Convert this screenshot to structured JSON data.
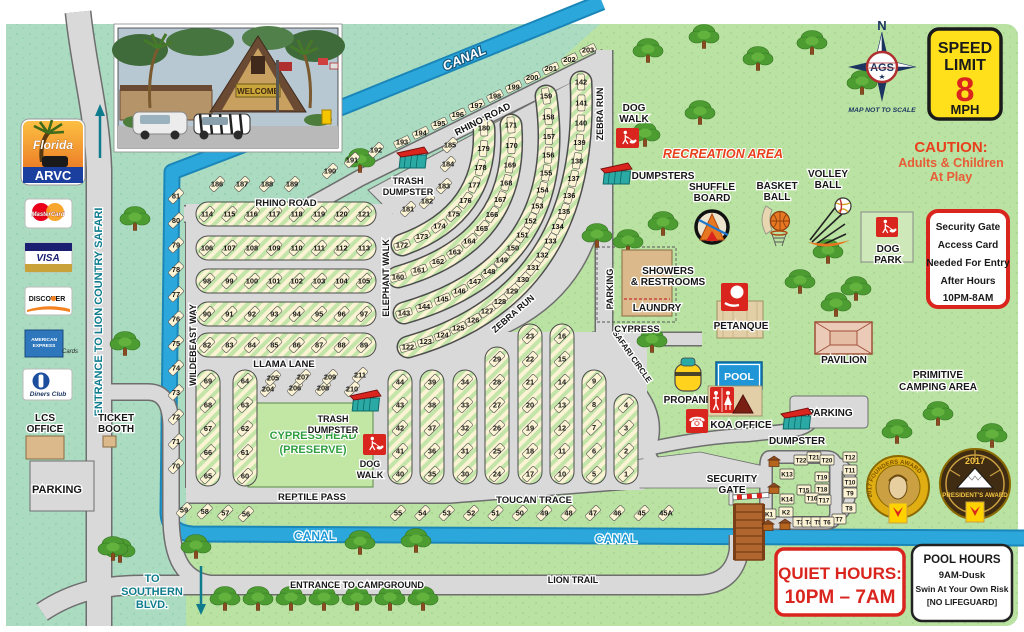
{
  "photo": {
    "welcome": "WELCOME"
  },
  "logo": {
    "florida": "Florida",
    "arvc": "ARVC"
  },
  "cards": {
    "mastercard": "MasterCard",
    "visa": "VISA",
    "discover": "DISCOVER",
    "amex1": "AMERICAN",
    "amex2": "EXPRESS",
    "amex_cards": "Cards",
    "diners": "Diners Club"
  },
  "left": {
    "entrance_lcs": "ENTRANCE TO LION COUNTRY SAFARI",
    "lcs1": "LCS",
    "lcs2": "OFFICE",
    "ticket1": "TICKET",
    "ticket2": "BOOTH",
    "parking": "PARKING",
    "south1": "TO",
    "south2": "SOUTHERN",
    "south3": "BLVD."
  },
  "compass": {
    "n": "N",
    "ags": "AGS",
    "note": "MAP NOT TO SCALE"
  },
  "speed": {
    "l1": "SPEED",
    "l2": "LIMIT",
    "num": "8",
    "mph": "MPH"
  },
  "caution": {
    "l1": "CAUTION:",
    "l2": "Adults & Children",
    "l3": "At Play"
  },
  "security_box": {
    "l1": "Security Gate",
    "l2": "Access Card",
    "l3": "Needed For Entry",
    "l4": "After Hours",
    "l5": "10PM-8AM"
  },
  "quiet": {
    "l1": "QUIET HOURS:",
    "l2": "10PM – 7AM"
  },
  "pool_hours": {
    "l1": "POOL HOURS",
    "l2": "9AM-Dusk",
    "l3": "Swin At Your Own Risk",
    "l4": "[NO LIFEGUARD]"
  },
  "awards": {
    "founders": "2017 FOUNDERS AWARD",
    "presidents_year": "2017",
    "presidents": "PRESIDENT'S AWARD"
  },
  "roads": {
    "rhino": "RHINO ROAD",
    "llama": "LLAMA LANE",
    "reptile": "REPTILE PASS",
    "toucan": "TOUCAN TRACE",
    "wildebeast": "WILDEBEAST WAY",
    "elephant": "ELEPHANT WALK",
    "zebra": "ZEBRA RUN",
    "safari": "SAFARI CIRCLE",
    "cypress": "CYPRESS",
    "lion": "LION TRAIL",
    "entrance_cg": "ENTRANCE TO CAMPGROUND",
    "canal": "CANAL"
  },
  "labels": {
    "recreation": "RECREATION AREA",
    "dog_walk1": "DOG",
    "dog_walk2": "WALK",
    "dog_park1": "DOG",
    "dog_park2": "PARK",
    "dumpsters": "DUMPSTERS",
    "dumpster": "DUMPSTER",
    "trash1": "TRASH",
    "trash2": "DUMPSTER",
    "shuffle1": "SHUFFLE",
    "shuffle2": "BOARD",
    "basket1": "BASKET",
    "basket2": "BALL",
    "volley1": "VOLLEY",
    "volley2": "BALL",
    "showers1": "SHOWERS",
    "showers2": "& RESTROOMS",
    "laundry": "LAUNDRY",
    "petanque": "PETANQUE",
    "pool": "POOL",
    "propane": "PROPANE",
    "koa": "KOA OFFICE",
    "pavilion": "PAVILION",
    "parking": "PARKING",
    "primitive1": "PRIMITIVE",
    "primitive2": "CAMPING AREA",
    "security1": "SECURITY",
    "security2": "GATE",
    "cypress_head1": "CYPRESS HEAD",
    "cypress_head2": "(PRESERVE)"
  },
  "colors": {
    "canal": "#2ba7dc",
    "teal_bg": "#abdcc2",
    "green_bg": "#bae2a3",
    "road": "#d9d9d9",
    "site_cream": "#fbf3d3",
    "accent_red": "#d9251d",
    "koa_yellow": "#ffd200"
  },
  "site_groups": [
    {
      "id": "row-114",
      "kind": "line",
      "from": [
        207,
        214
      ],
      "to": [
        364,
        214
      ],
      "nums": [
        "114",
        "115",
        "116",
        "117",
        "118",
        "119",
        "120",
        "121"
      ]
    },
    {
      "id": "row-106",
      "kind": "line",
      "from": [
        207,
        248
      ],
      "to": [
        364,
        248
      ],
      "nums": [
        "106",
        "107",
        "108",
        "109",
        "110",
        "111",
        "112",
        "113"
      ]
    },
    {
      "id": "row-98",
      "kind": "line",
      "from": [
        207,
        281
      ],
      "to": [
        364,
        281
      ],
      "nums": [
        "98",
        "99",
        "100",
        "101",
        "102",
        "103",
        "104",
        "105"
      ]
    },
    {
      "id": "row-90",
      "kind": "line",
      "from": [
        207,
        314
      ],
      "to": [
        364,
        314
      ],
      "nums": [
        "90",
        "91",
        "92",
        "93",
        "94",
        "95",
        "96",
        "97"
      ]
    },
    {
      "id": "row-82",
      "kind": "line",
      "from": [
        207,
        345
      ],
      "to": [
        364,
        345
      ],
      "nums": [
        "82",
        "83",
        "84",
        "85",
        "86",
        "87",
        "88",
        "89"
      ]
    },
    {
      "id": "col-w",
      "kind": "line",
      "from": [
        176,
        196
      ],
      "to": [
        176,
        466
      ],
      "nums": [
        "81",
        "80",
        "79",
        "78",
        "77",
        "76",
        "75",
        "74",
        "73",
        "72",
        "71",
        "70"
      ]
    },
    {
      "id": "col-69",
      "kind": "line",
      "from": [
        208,
        381
      ],
      "to": [
        208,
        476
      ],
      "nums": [
        "69",
        "68",
        "67",
        "66",
        "65"
      ]
    },
    {
      "id": "col-64",
      "kind": "line",
      "from": [
        245,
        381
      ],
      "to": [
        245,
        476
      ],
      "nums": [
        "64",
        "63",
        "62",
        "61",
        "60"
      ]
    },
    {
      "id": "col-44",
      "kind": "line",
      "from": [
        400,
        382
      ],
      "to": [
        400,
        474
      ],
      "nums": [
        "44",
        "43",
        "42",
        "41",
        "40"
      ]
    },
    {
      "id": "col-39",
      "kind": "line",
      "from": [
        432,
        382
      ],
      "to": [
        432,
        474
      ],
      "nums": [
        "39",
        "38",
        "37",
        "36",
        "35"
      ]
    },
    {
      "id": "col-34",
      "kind": "line",
      "from": [
        465,
        382
      ],
      "to": [
        465,
        474
      ],
      "nums": [
        "34",
        "33",
        "32",
        "31",
        "30"
      ]
    },
    {
      "id": "col-29",
      "kind": "line",
      "from": [
        497,
        359
      ],
      "to": [
        497,
        474
      ],
      "nums": [
        "29",
        "28",
        "27",
        "26",
        "25",
        "24"
      ]
    },
    {
      "id": "col-23",
      "kind": "line",
      "from": [
        530,
        336
      ],
      "to": [
        530,
        474
      ],
      "nums": [
        "23",
        "22",
        "21",
        "20",
        "19",
        "18",
        "17"
      ]
    },
    {
      "id": "col-16",
      "kind": "line",
      "from": [
        562,
        336
      ],
      "to": [
        562,
        474
      ],
      "nums": [
        "16",
        "15",
        "14",
        "13",
        "12",
        "11",
        "10"
      ]
    },
    {
      "id": "col-9",
      "kind": "line",
      "from": [
        594,
        381
      ],
      "to": [
        594,
        474
      ],
      "nums": [
        "9",
        "8",
        "7",
        "6",
        "5"
      ]
    },
    {
      "id": "col-4",
      "kind": "line",
      "from": [
        626,
        405
      ],
      "to": [
        626,
        474
      ],
      "nums": [
        "4",
        "3",
        "2",
        "1"
      ]
    },
    {
      "id": "row-59",
      "kind": "line",
      "from": [
        184,
        510
      ],
      "to": [
        246,
        514
      ],
      "nums": [
        "59",
        "58",
        "57",
        "56"
      ]
    },
    {
      "id": "row-55",
      "kind": "line",
      "from": [
        398,
        513
      ],
      "to": [
        666,
        513
      ],
      "nums": [
        "55",
        "54",
        "53",
        "52",
        "51",
        "50",
        "49",
        "48",
        "47",
        "46",
        "45",
        "45A"
      ]
    },
    {
      "id": "arc-122",
      "kind": "bezier",
      "p0": [
        408,
        347
      ],
      "c": [
        590,
        295
      ],
      "p2": [
        581,
        82
      ],
      "nums": [
        "122",
        "123",
        "124",
        "125",
        "126",
        "127",
        "128",
        "129",
        "130",
        "131",
        "132",
        "133",
        "134",
        "135",
        "136",
        "137",
        "138",
        "139",
        "140",
        "141",
        "142"
      ]
    },
    {
      "id": "arc-143",
      "kind": "bezier",
      "p0": [
        404,
        313
      ],
      "c": [
        570,
        265
      ],
      "p2": [
        546,
        96
      ],
      "nums": [
        "143",
        "144",
        "145",
        "146",
        "147",
        "148",
        "149",
        "150",
        "151",
        "152",
        "153",
        "154",
        "155",
        "156",
        "157",
        "158",
        "159"
      ]
    },
    {
      "id": "arc-160",
      "kind": "bezier",
      "p0": [
        398,
        277
      ],
      "c": [
        520,
        242
      ],
      "p2": [
        511,
        125
      ],
      "nums": [
        "160",
        "161",
        "162",
        "163",
        "164",
        "165",
        "166",
        "167",
        "168",
        "169",
        "170",
        "171"
      ]
    },
    {
      "id": "arc-172",
      "kind": "bezier",
      "p0": [
        402,
        245
      ],
      "c": [
        488,
        214
      ],
      "p2": [
        484,
        128
      ],
      "nums": [
        "172",
        "173",
        "174",
        "175",
        "176",
        "177",
        "178",
        "179",
        "180"
      ]
    },
    {
      "id": "pts-181",
      "kind": "points",
      "pts": [
        [
          408,
          209
        ],
        [
          427,
          201
        ],
        [
          444,
          186
        ],
        [
          448,
          164
        ],
        [
          450,
          145
        ]
      ],
      "nums": [
        "181",
        "182",
        "183",
        "184",
        "185"
      ]
    },
    {
      "id": "row-186",
      "kind": "line",
      "from": [
        217,
        184
      ],
      "to": [
        292,
        184
      ],
      "nums": [
        "186",
        "187",
        "188",
        "189"
      ]
    },
    {
      "id": "pts-190",
      "kind": "points",
      "pts": [
        [
          330,
          171
        ],
        [
          352,
          160
        ]
      ],
      "nums": [
        "190",
        "191"
      ]
    },
    {
      "id": "pts-192",
      "kind": "points",
      "pts": [
        [
          376,
          150
        ]
      ],
      "nums": [
        "192"
      ]
    },
    {
      "id": "row-193",
      "kind": "line",
      "from": [
        402,
        142
      ],
      "to": [
        588,
        50
      ],
      "mangle": 64,
      "nums": [
        "193",
        "194",
        "195",
        "196",
        "197",
        "198",
        "199",
        "200",
        "201",
        "202",
        "203"
      ]
    },
    {
      "id": "pts-204",
      "kind": "points",
      "pts": [
        [
          268,
          389
        ],
        [
          273,
          378
        ],
        [
          295,
          388
        ],
        [
          303,
          377
        ],
        [
          323,
          388
        ],
        [
          330,
          377
        ],
        [
          352,
          389
        ],
        [
          360,
          375
        ]
      ],
      "nums": [
        "204",
        "205",
        "206",
        "207",
        "208",
        "209",
        "210",
        "211"
      ]
    },
    {
      "id": "tk-block",
      "kind": "points",
      "marker": "cell",
      "pts": [
        [
          801,
          460
        ],
        [
          814,
          457
        ],
        [
          827,
          460
        ],
        [
          850,
          457
        ],
        [
          787,
          474
        ],
        [
          822,
          477
        ],
        [
          850,
          470
        ],
        [
          850,
          482
        ],
        [
          804,
          490
        ],
        [
          822,
          489
        ],
        [
          850,
          493
        ],
        [
          787,
          499
        ],
        [
          812,
          498
        ],
        [
          824,
          500
        ],
        [
          849,
          508
        ],
        [
          839,
          519
        ],
        [
          769,
          514
        ],
        [
          786,
          512
        ],
        [
          800,
          522
        ],
        [
          809,
          522
        ],
        [
          818,
          522
        ],
        [
          827,
          522
        ]
      ],
      "nums": [
        "T22",
        "T21",
        "T20",
        "T12",
        "K13",
        "T19",
        "T11",
        "T10",
        "T15",
        "T18",
        "T9",
        "K14",
        "T16",
        "T17",
        "T8",
        "T7",
        "K1",
        "K2",
        "T3",
        "T4",
        "T5",
        "T6"
      ]
    }
  ],
  "trees": [
    [
      135,
      230
    ],
    [
      125,
      355
    ],
    [
      120,
      562
    ],
    [
      360,
      172
    ],
    [
      652,
      352
    ],
    [
      800,
      293
    ],
    [
      856,
      300
    ],
    [
      648,
      62
    ],
    [
      704,
      48
    ],
    [
      758,
      70
    ],
    [
      812,
      54
    ],
    [
      862,
      94
    ],
    [
      700,
      124
    ],
    [
      645,
      146
    ],
    [
      663,
      235
    ],
    [
      628,
      253
    ],
    [
      828,
      263
    ],
    [
      836,
      316
    ],
    [
      897,
      443
    ],
    [
      938,
      425
    ],
    [
      992,
      447
    ],
    [
      225,
      610
    ],
    [
      258,
      610
    ],
    [
      291,
      610
    ],
    [
      324,
      610
    ],
    [
      357,
      610
    ],
    [
      390,
      610
    ],
    [
      423,
      610
    ],
    [
      113,
      560
    ],
    [
      196,
      558
    ],
    [
      360,
      554
    ],
    [
      416,
      552
    ],
    [
      597,
      247
    ]
  ]
}
